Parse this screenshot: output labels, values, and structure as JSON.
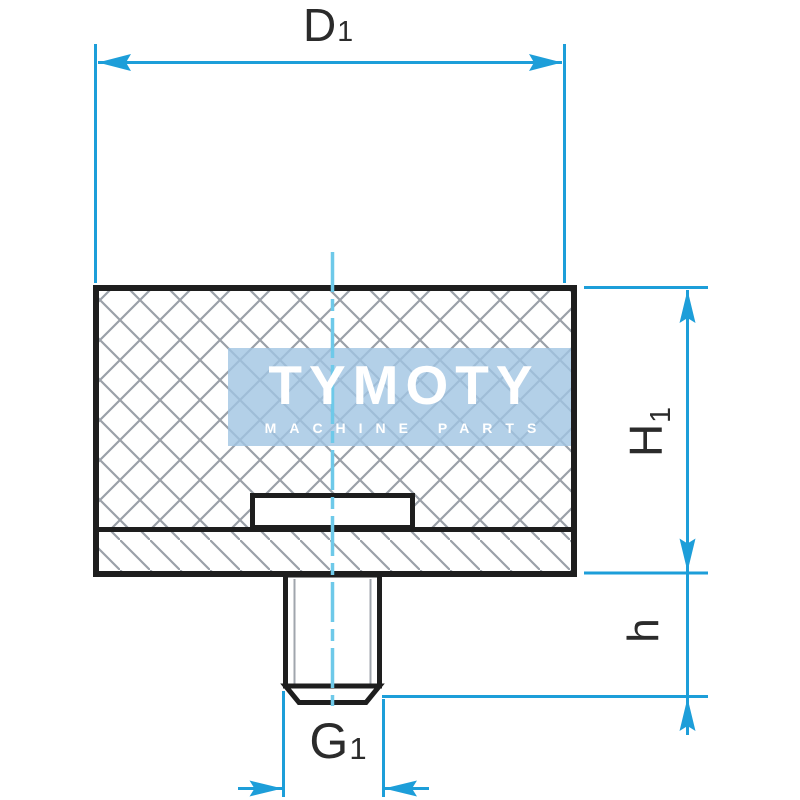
{
  "watermark": {
    "brand": "TYMOTY",
    "tagline": "MACHINE PARTS"
  },
  "dimension_labels": {
    "top_diameter": {
      "symbol": "D",
      "subscript": "1"
    },
    "body_height": {
      "symbol": "H",
      "subscript": "1"
    },
    "stud_length": {
      "symbol": "h",
      "subscript": ""
    },
    "thread_size": {
      "symbol": "G",
      "subscript": "1"
    }
  },
  "colors": {
    "dimension_lines": "#1d9ed9",
    "center_line": "#6ec9e9",
    "part_outline": "#1e1e1e",
    "hatch_lines": "#9aa0a8",
    "watermark_background": "#a0c4e2",
    "watermark_text": "#ffffff",
    "label_text": "#2b2b2b",
    "background": "#ffffff"
  }
}
